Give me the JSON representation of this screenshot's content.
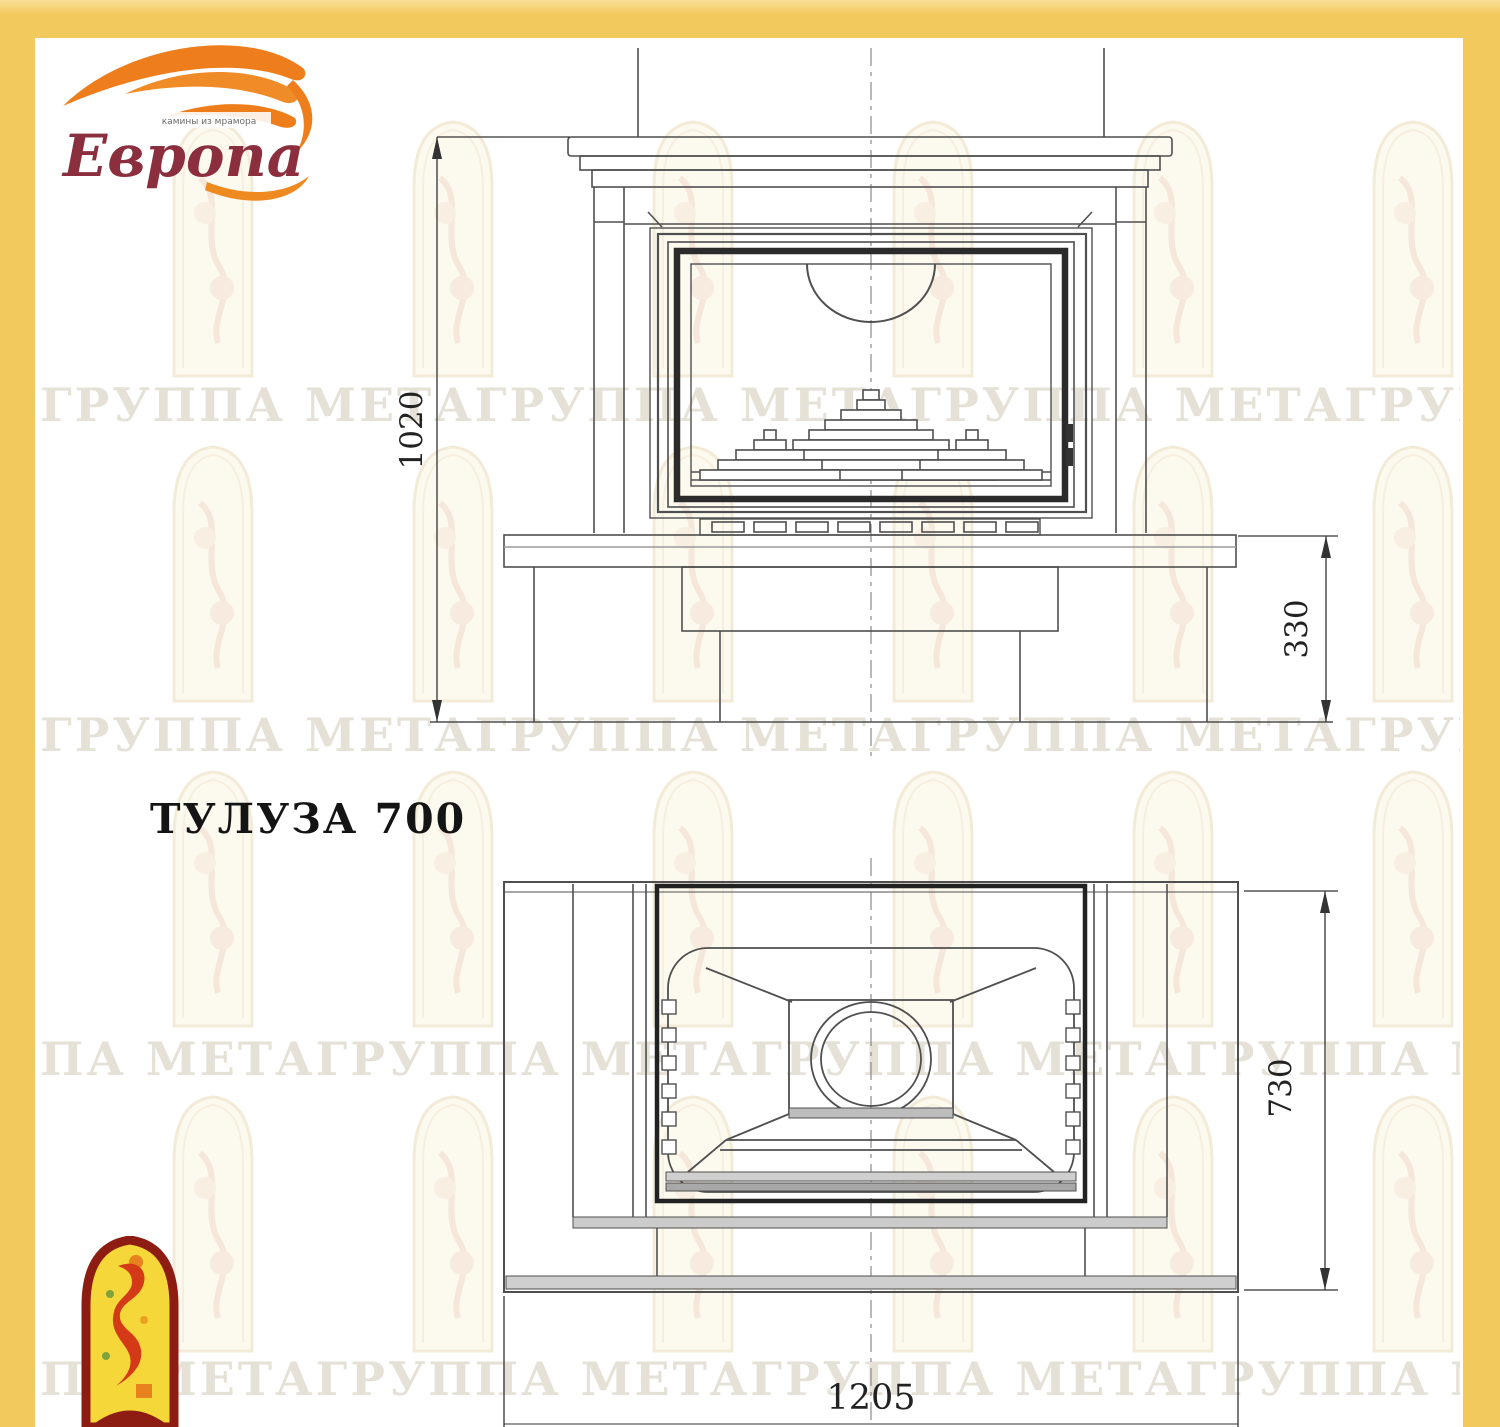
{
  "page": {
    "background_color": "#f2c95c",
    "paper_color": "#ffffff"
  },
  "logo": {
    "brand": "Европа",
    "tagline": "камины из мрамора",
    "flame_color": "#ee7d1c",
    "brand_color": "#8b2f3e"
  },
  "title": "ТУЛУЗА 700",
  "watermark_rows": [
    "ГРУППА МЕТАГРУППА МЕТАГРУППА МЕТАГРУППА МЕТА",
    "ГРУППА МЕТАГРУППА МЕТАГРУППА МЕТАГРУППА МЕТА",
    "ПА МЕТАГРУППА МЕТАГРУППА МЕТАГРУППА МЕТА",
    "ПА МЕТАГРУППА МЕТАГРУППА МЕТАГРУППА МЕТ"
  ],
  "front_view": {
    "height_mm": "1020",
    "plinth_height_mm": "330"
  },
  "plan_view": {
    "depth_mm": "730",
    "width_mm": "1205"
  }
}
